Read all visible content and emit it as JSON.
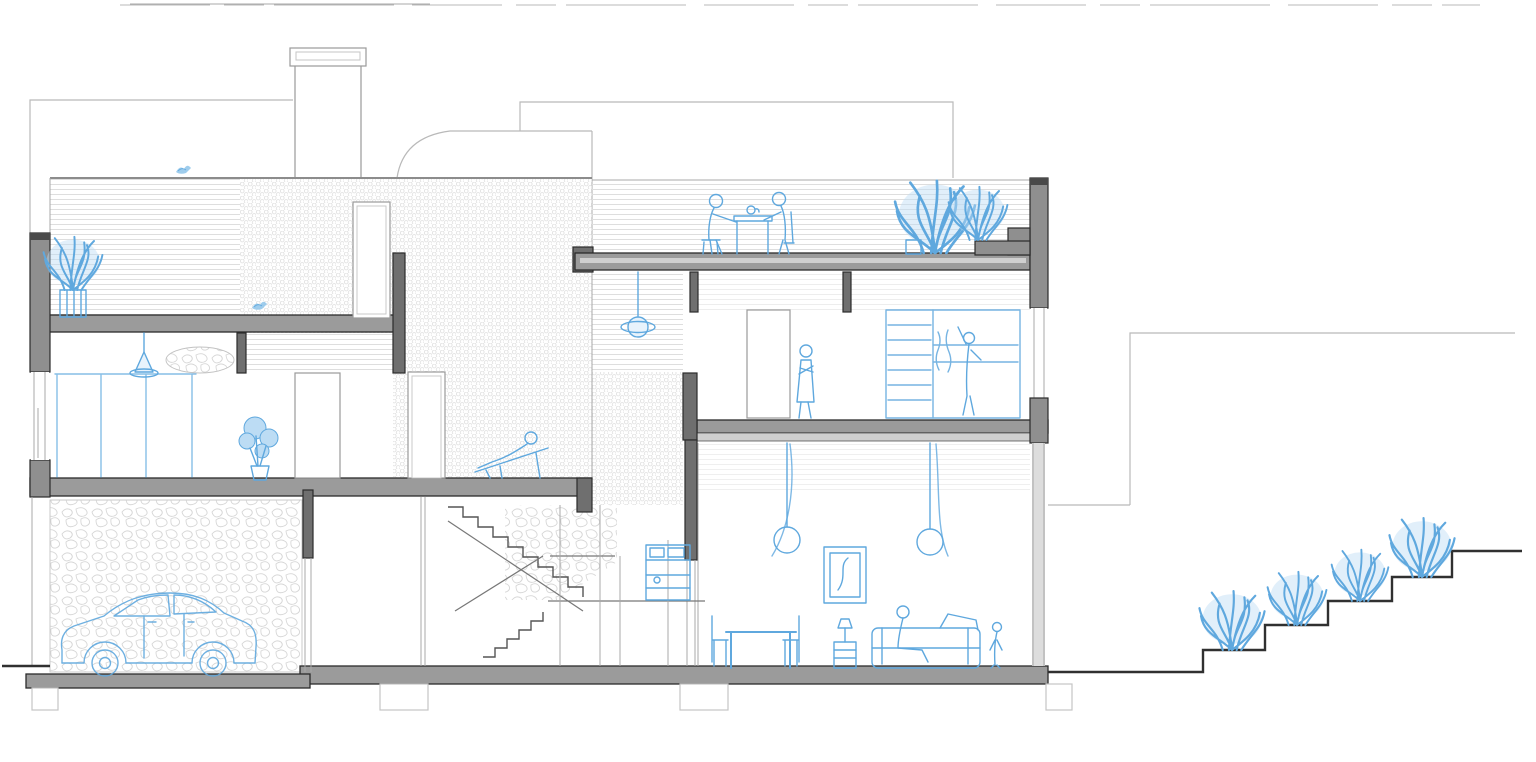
{
  "document": {
    "svg_title": "Architectural cross-section drawing of a three-level house with garage, switchback staircase, roof terrace and landscaped garden steps"
  },
  "palette": {
    "paper": "#ffffff",
    "sketch-blue": "#5fa8de",
    "sketch-blue-fill": "#bcdcf4",
    "wall-dark": "#6f6f6f",
    "wall-mid": "#8f8f8f",
    "wall-outline": "#2b2b2b",
    "slab-gray": "#9b9b9b",
    "light-gray": "#b9b9b9",
    "hatch-gray": "#dedede",
    "ground-dark": "#303030"
  },
  "entities": [
    "chimney",
    "roof-terrace",
    "dining-people",
    "terrace-plants",
    "parapet-wall",
    "bedroom-person",
    "wardrobe-person",
    "pendant-lamp",
    "lounge-person",
    "monstera-plant",
    "roof-plant",
    "bird",
    "window-mullions",
    "curtains",
    "picture-frame",
    "dining-table",
    "sofa-person",
    "child-figure",
    "kitchen-unit",
    "staircase",
    "car",
    "stone-wall",
    "foundation-footings",
    "garden-steps",
    "garden-bushes",
    "background-buildings"
  ]
}
